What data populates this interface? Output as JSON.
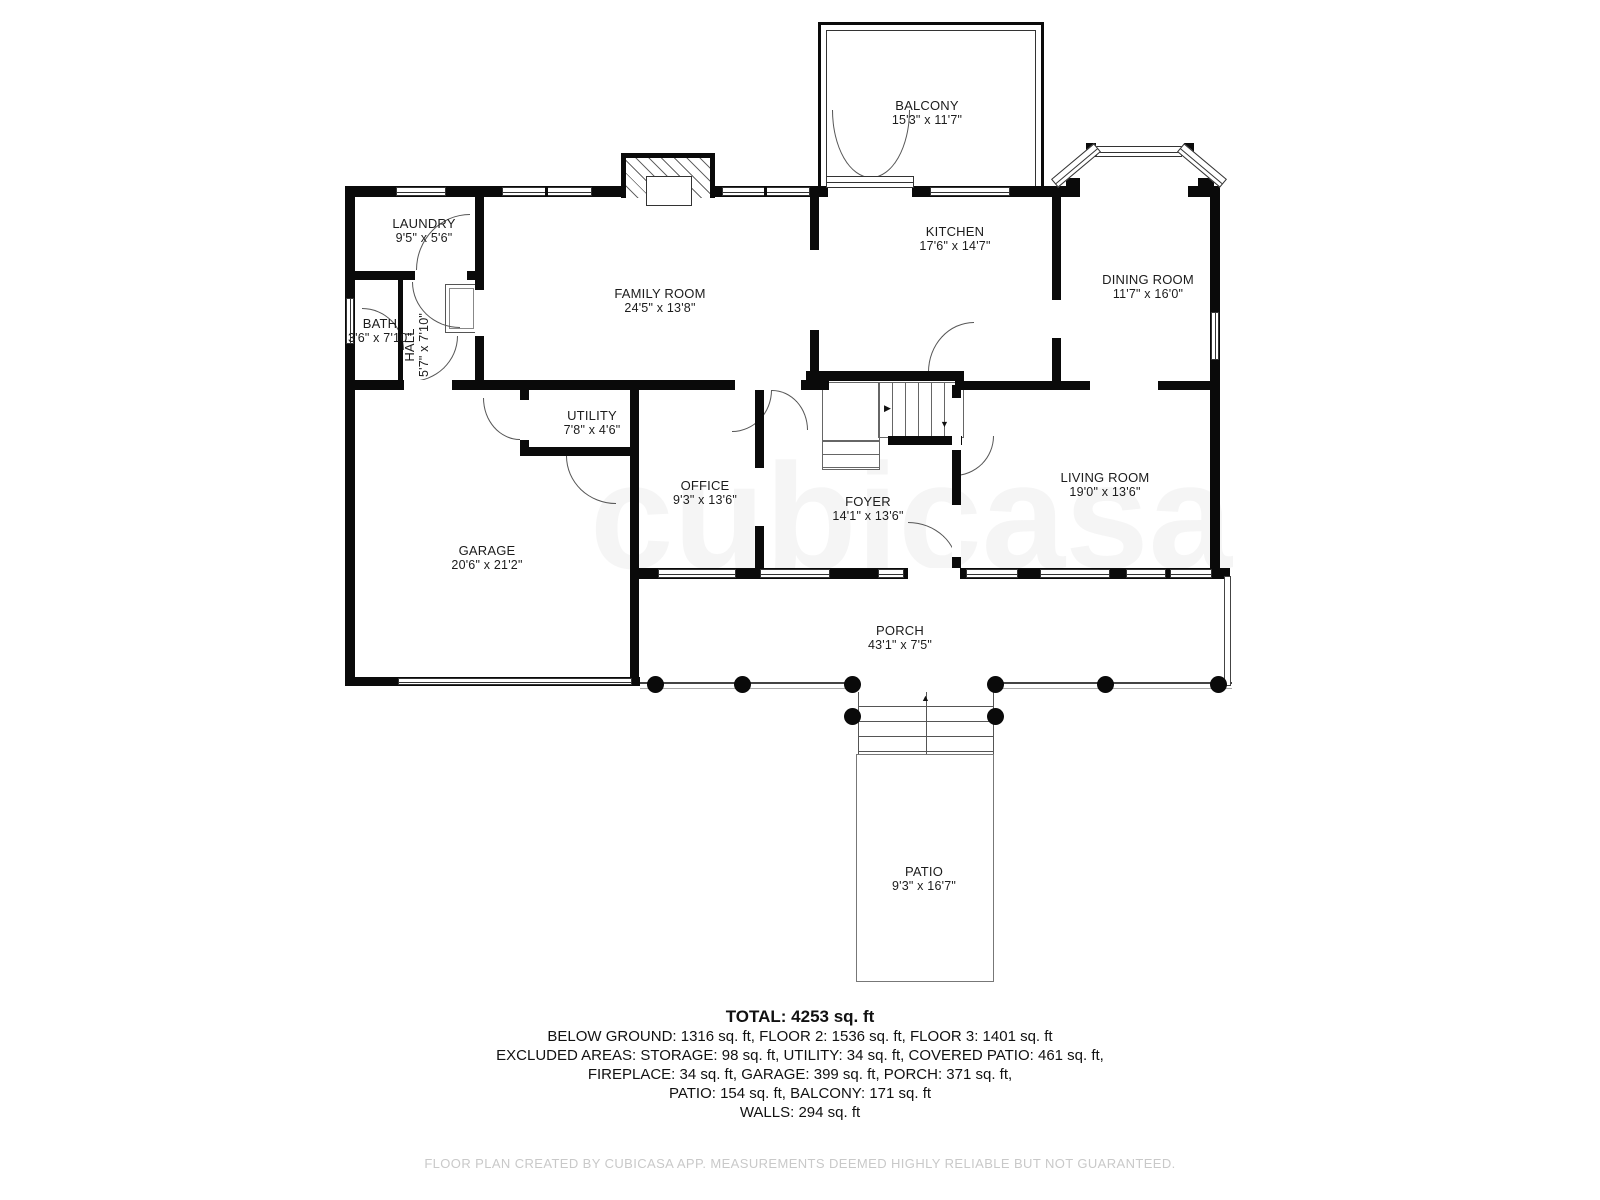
{
  "rooms": [
    {
      "id": "balcony",
      "name": "BALCONY",
      "dims": "15'3\" x 11'7\""
    },
    {
      "id": "laundry",
      "name": "LAUNDRY",
      "dims": "9'5\" x 5'6\""
    },
    {
      "id": "family-room",
      "name": "FAMILY ROOM",
      "dims": "24'5\" x 13'8\""
    },
    {
      "id": "kitchen",
      "name": "KITCHEN",
      "dims": "17'6\" x 14'7\""
    },
    {
      "id": "dining-room",
      "name": "DINING ROOM",
      "dims": "11'7\" x 16'0\""
    },
    {
      "id": "bath",
      "name": "BATH",
      "dims": "3'6\" x 7'10\""
    },
    {
      "id": "hall",
      "name": "HALL",
      "dims": "5'7\" x 7'10\""
    },
    {
      "id": "utility",
      "name": "UTILITY",
      "dims": "7'8\" x 4'6\""
    },
    {
      "id": "office",
      "name": "OFFICE",
      "dims": "9'3\" x 13'6\""
    },
    {
      "id": "foyer",
      "name": "FOYER",
      "dims": "14'1\" x 13'6\""
    },
    {
      "id": "living-room",
      "name": "LIVING ROOM",
      "dims": "19'0\" x 13'6\""
    },
    {
      "id": "garage",
      "name": "GARAGE",
      "dims": "20'6\" x 21'2\""
    },
    {
      "id": "porch",
      "name": "PORCH",
      "dims": "43'1\" x 7'5\""
    },
    {
      "id": "patio",
      "name": "PATIO",
      "dims": "9'3\" x 16'7\""
    }
  ],
  "summary": {
    "total": "TOTAL: 4253 sq. ft",
    "lines": [
      "BELOW GROUND: 1316 sq. ft, FLOOR 2: 1536 sq. ft, FLOOR 3: 1401 sq. ft",
      "EXCLUDED AREAS: STORAGE: 98 sq. ft, UTILITY: 34 sq. ft, COVERED PATIO: 461 sq. ft,",
      "FIREPLACE: 34 sq. ft, GARAGE: 399 sq. ft, PORCH: 371 sq. ft,",
      "PATIO: 154 sq. ft, BALCONY: 171 sq. ft",
      "WALLS: 294 sq. ft"
    ]
  },
  "watermark": "cubicasa",
  "footer": "FLOOR PLAN CREATED BY CUBICASA APP. MEASUREMENTS DEEMED HIGHLY RELIABLE BUT NOT GUARANTEED."
}
